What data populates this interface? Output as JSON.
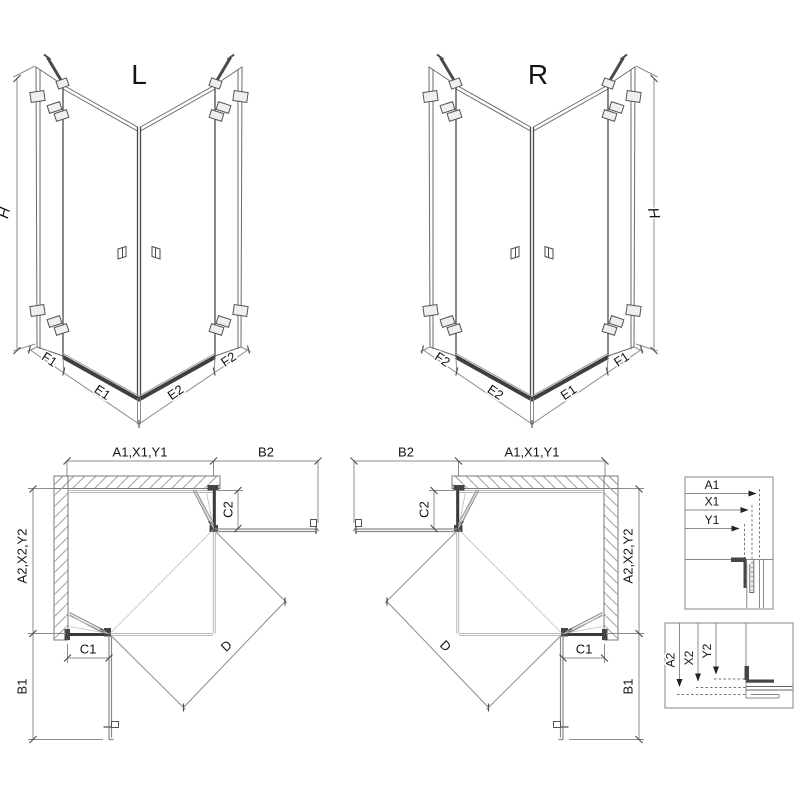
{
  "diagram": {
    "title": "corner shower enclosure dimension drawing",
    "labels": {
      "view_left": "L",
      "view_right": "R",
      "h": "H",
      "f1": "F1",
      "e1": "E1",
      "e2": "E2",
      "f2": "F2",
      "a1_group": "A1,X1,Y1",
      "b2": "B2",
      "c2": "C2",
      "a2_group": "A2,X2,Y2",
      "c1": "C1",
      "b1": "B1",
      "d": "D",
      "a1": "A1",
      "x1": "X1",
      "y1": "Y1",
      "a2": "A2",
      "x2": "X2",
      "y2": "Y2"
    },
    "colors": {
      "line": "#3a3a3a",
      "dimension": "#8c8c8c",
      "hatch": "#9f9f9f",
      "background": "#ffffff"
    }
  }
}
